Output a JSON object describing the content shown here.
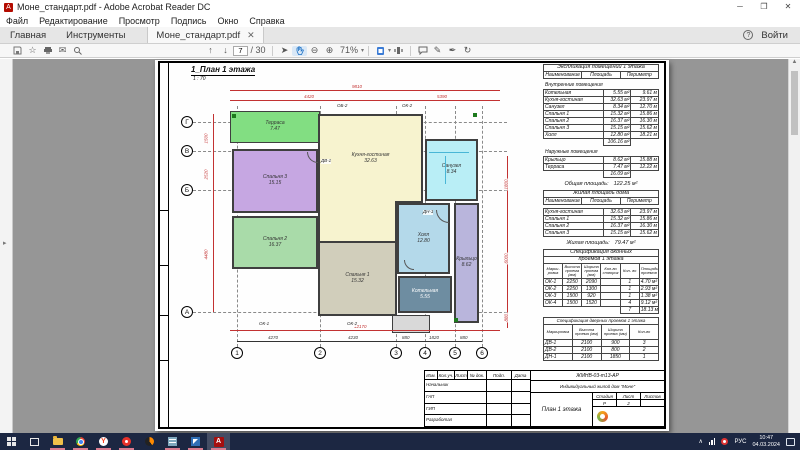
{
  "window": {
    "title": "Моне_стандарт.pdf - Adobe Acrobat Reader DC"
  },
  "menu": {
    "items": [
      "Файл",
      "Редактирование",
      "Просмотр",
      "Подпись",
      "Окно",
      "Справка"
    ]
  },
  "tabs": {
    "home": "Главная",
    "tools": "Инструменты",
    "doc": "Моне_стандарт.pdf",
    "signin": "Войти"
  },
  "toolbar": {
    "page": "7",
    "pages": "/ 30",
    "zoom": "71%",
    "icons": [
      "save-icon",
      "star-icon",
      "print-icon",
      "email-icon",
      "search-icon",
      "page-up-icon",
      "page-down-icon",
      "pointer-icon",
      "hand-tool-icon",
      "zoom-out-icon",
      "zoom-in-icon",
      "zoom-level",
      "fit-page-icon",
      "page-view-icon",
      "comment-icon",
      "pencil-icon",
      "signature-icon",
      "rotate-icon"
    ]
  },
  "drawing": {
    "title": "1_План 1 этажа",
    "scale": "1 : 70",
    "axes_rows": [
      "Г",
      "В",
      "Б",
      "А"
    ],
    "axes_cols": [
      "1",
      "2",
      "3",
      "4",
      "5",
      "6"
    ],
    "rooms": [
      {
        "name": "Терраса",
        "area": "7.47",
        "color": "#82de82"
      },
      {
        "name": "Спальня 3",
        "area": "15.15",
        "color": "#c6a7e2"
      },
      {
        "name": "Спальня 2",
        "area": "16.37",
        "color": "#a9dba9"
      },
      {
        "name": "Кухня-гостиная",
        "area": "32.63",
        "color": "#f7f3cf"
      },
      {
        "name": "Спальня 1",
        "area": "15.32",
        "color": "#d1cebb"
      },
      {
        "name": "Санузел",
        "area": "8.34",
        "color": "#b9eef6"
      },
      {
        "name": "Холл",
        "area": "12.80",
        "color": "#b4d9ea"
      },
      {
        "name": "Котельная",
        "area": "5.55",
        "color": "#6e8da1",
        "text": "#ffffff"
      },
      {
        "name": "Крыльцо",
        "area": "8.62",
        "color": "#b9b5dc"
      },
      {
        "name": "",
        "area": "",
        "color": "#d9d9d9"
      }
    ],
    "marks": [
      "ОБ-2",
      "ОК-2",
      "ОК-1",
      "ОК-2",
      "ДВ-1",
      "ДН-1"
    ],
    "dims": {
      "top": "9810",
      "top_l": "4420",
      "top_r": "5390",
      "bottom": "12170",
      "bottom_segs": [
        "4270",
        "4230",
        "880",
        "1820",
        "880"
      ],
      "left_segs": [
        "1500",
        "2520",
        "4480"
      ],
      "right_segs": [
        "1800",
        "6000",
        "880"
      ]
    }
  },
  "tables": {
    "explication": {
      "title": "Экспликация помещений 1 этажа",
      "cols": [
        "Наименование",
        "Площадь",
        "Периметр"
      ],
      "sec1": "Внутренние помещения",
      "rows": [
        [
          "Котельная",
          "5.55 м²",
          "9.61 м"
        ],
        [
          "Кухня-гостиная",
          "32.63 м²",
          "23.97 м"
        ],
        [
          "Санузел",
          "8.34 м²",
          "12.70 м"
        ],
        [
          "Спальня 1",
          "15.32 м²",
          "15.86 м"
        ],
        [
          "Спальня 2",
          "16.37 м²",
          "16.30 м"
        ],
        [
          "Спальня 3",
          "15.15 м²",
          "15.62 м"
        ],
        [
          "Холл",
          "12.80 м²",
          "18.21 м"
        ]
      ],
      "sub1": "106.16 м²",
      "sec2": "Наружные помещения",
      "rows2": [
        [
          "Крыльцо",
          "8.62 м²",
          "15.88 м"
        ],
        [
          "Терраса",
          "7.47 м²",
          "12.22 м"
        ]
      ],
      "sub2": "16.09 м²",
      "total_label": "Общая площадь:",
      "total": "122.25 м²"
    },
    "living": {
      "title": "Жилая площадь дома",
      "cols": [
        "Наименование",
        "Площадь",
        "Периметр"
      ],
      "rows": [
        [
          "Кухня-гостиная",
          "32.63 м²",
          "23.97 м"
        ],
        [
          "Спальня 1",
          "15.32 м²",
          "15.86 м"
        ],
        [
          "Спальня 2",
          "16.37 м²",
          "16.30 м"
        ],
        [
          "Спальня 3",
          "15.15 м²",
          "15.62 м"
        ]
      ],
      "total_label": "Жилая площадь:",
      "total": "79.47 м²"
    },
    "windows": {
      "title1": "Спецификация оконных",
      "title2": "проемов 1 этажа",
      "cols": [
        "Марки- ровка",
        "Высота проема (мм)",
        "Ширина проема (мм)",
        "Кол-во створок",
        "Кол- во",
        "Площадь проемов"
      ],
      "rows": [
        [
          "ОК-1",
          "2250",
          "2090",
          "",
          "1",
          "4.70 м²"
        ],
        [
          "ОК-2",
          "2250",
          "1300",
          "",
          "1",
          "2.93 м²"
        ],
        [
          "ОК-3",
          "1500",
          "920",
          "",
          "1",
          "1.38 м²"
        ],
        [
          "ОК-4",
          "1500",
          "1520",
          "",
          "4",
          "9.12 м²"
        ]
      ],
      "total_count": "7",
      "total_area": "18.13 м²"
    },
    "doors": {
      "title": "Спецификация дверных проемов 1 этажа",
      "cols": [
        "Маркировка",
        "Высота проема (мм)",
        "Ширина проема (мм)",
        "Кол-во"
      ],
      "rows": [
        [
          "ДВ-1",
          "2100",
          "900",
          "3"
        ],
        [
          "ДВ-2",
          "2100",
          "800",
          "2"
        ],
        [
          "ДН-1",
          "2100",
          "1850",
          "1"
        ]
      ]
    }
  },
  "titleblock": {
    "code": "ЖМНВ-03-т13-АР",
    "project": "Индивидуальный жилой дом \"Моне\"",
    "cols": [
      "Изм.",
      "Кол.уч.",
      "Лист",
      "№ док.",
      "Подп.",
      "Дата"
    ],
    "roles": [
      "Начальник",
      "ГАП",
      "ГИП",
      "Разработал"
    ],
    "sheet_title": "План 1 этажа",
    "stage_label": "Стадия",
    "list_label": "Лист",
    "lists_label": "Листов",
    "stage": "Р",
    "list": "2"
  },
  "taskbar": {
    "lang": "РУС",
    "time": "10:47",
    "date": "04.03.2024",
    "icons": [
      "start-icon",
      "task-view-icon",
      "explorer-icon",
      "chrome-icon",
      "yandex-browser-icon",
      "red-app-icon",
      "orange-app-icon",
      "teal-app-icon",
      "blue-app-icon",
      "acrobat-icon",
      "chevron-up-icon",
      "network-icon",
      "notifier-badge-icon",
      "language-indicator",
      "clock",
      "action-center-icon"
    ]
  },
  "colors": {
    "dim_red": "#c23232",
    "taskbar_bg": "#1c2742",
    "doc_bg": "#969696",
    "acrobat_red": "#b30b00"
  }
}
